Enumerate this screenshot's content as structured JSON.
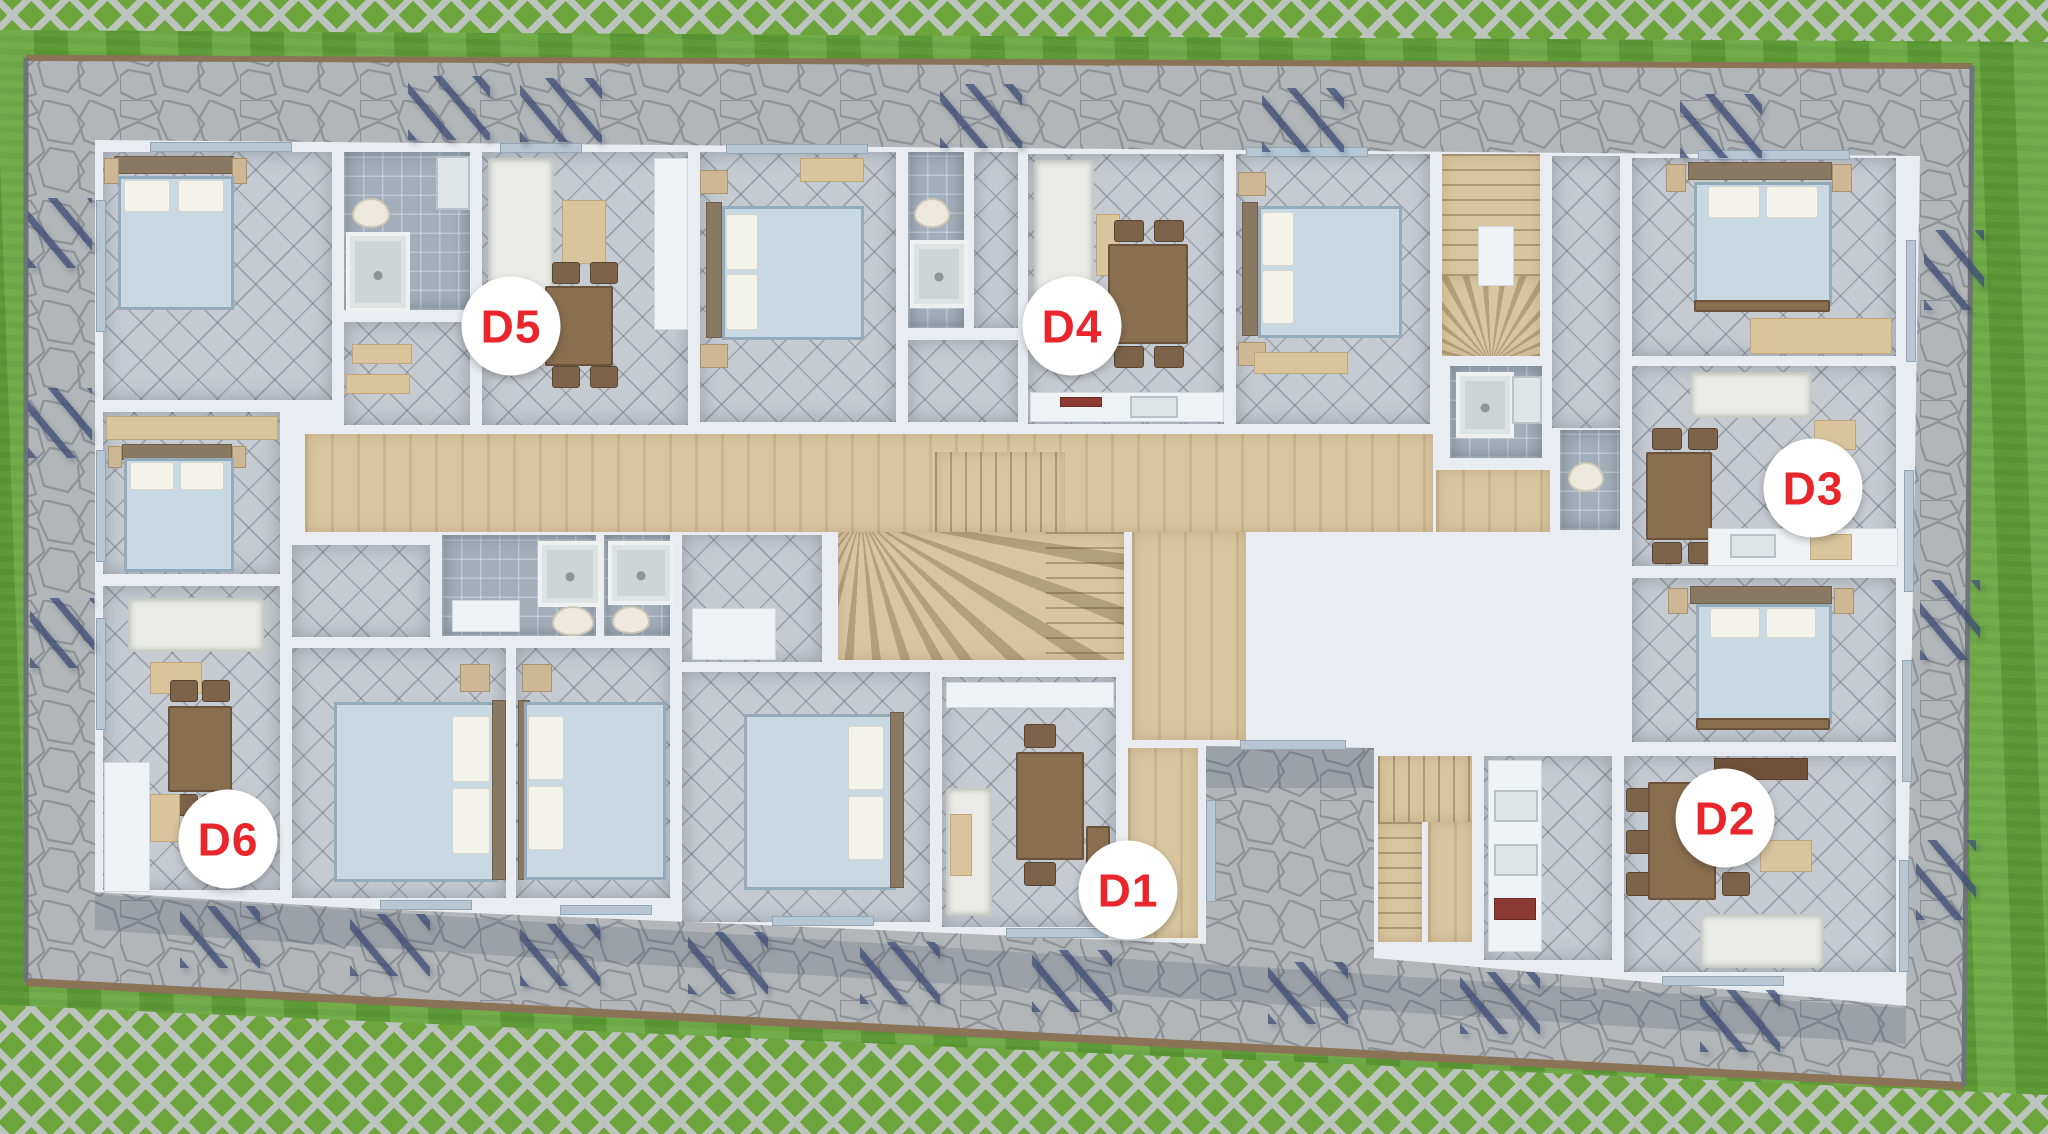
{
  "scene_type": "3d-floor-plan-top-view",
  "units": [
    {
      "label": "D1",
      "x": 1128,
      "y": 890
    },
    {
      "label": "D2",
      "x": 1725,
      "y": 818
    },
    {
      "label": "D3",
      "x": 1813,
      "y": 488
    },
    {
      "label": "D4",
      "x": 1072,
      "y": 326
    },
    {
      "label": "D5",
      "x": 511,
      "y": 326
    },
    {
      "label": "D6",
      "x": 228,
      "y": 839
    }
  ],
  "palette": {
    "label_text": "#E8262B",
    "label_bg": "#FFFFFF",
    "grass": "#69A83F",
    "paver_lattice": "#BDC4C0",
    "patio_stone": "#B2B6B9",
    "patio_joint": "#878C91",
    "patio_border_wood": "#8B7357",
    "wall": "#E9EDF1",
    "tile_floor": "#C6CBD1",
    "bath_tile": "#A2AEB9",
    "wood_floor": "#D9C6A0",
    "bed_linen": "#C8D9E3",
    "furniture_wood": "#8A6E50",
    "awning_shadow": "#3E5078"
  }
}
